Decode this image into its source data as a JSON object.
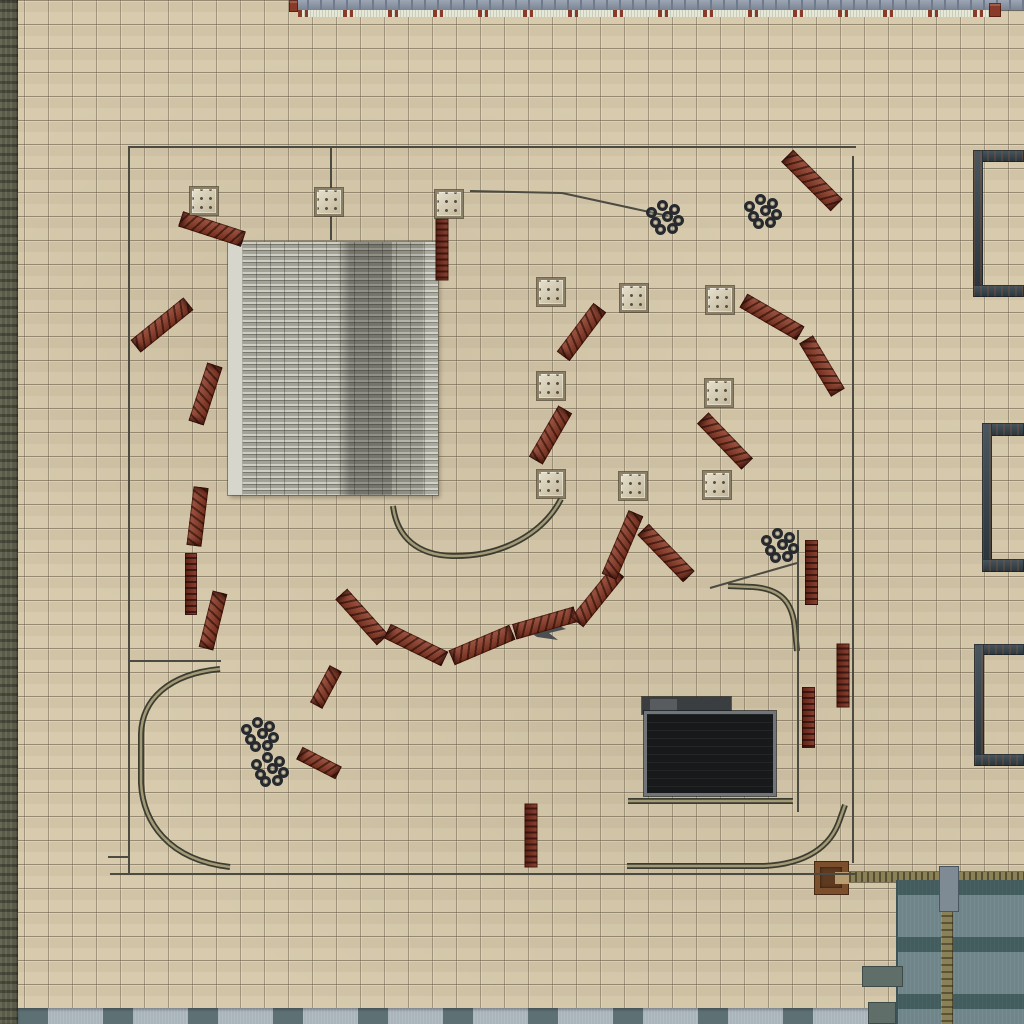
{
  "scene": {
    "description": "top-down desert training compound map with barriers, crates, tire stacks and track curves",
    "width": 1024,
    "height": 1024
  },
  "palette": {
    "ground": "#d7caad",
    "leftStrip": "#5b5b49",
    "topRoof": "#8b96a7",
    "topRoofSeam": "#6f7a8c",
    "paleStrip": "#e6e8d7",
    "redMark": "#8a3a28",
    "bStrip": "#a9b4bb",
    "bStripDark": "#5d7074",
    "roofMid": "#a2a296",
    "bracket": "#36444d",
    "darkUpper": "#3b3e40",
    "darkRoof": "#17191b",
    "darkFrame": "#70757a",
    "cornerBody": "#6f8589",
    "seamKhaki": "#8b8157",
    "wood": "#7c4f2c",
    "barrier": "#8f3a25",
    "ladderBase": "#7c2d1c",
    "crate": "#d9cfb2",
    "crateEdge": "#8b8066",
    "crateDot": "#5a5142",
    "tire": "#262a2f",
    "line": "#4b4b41",
    "trackDark": "#3c3c30",
    "trackKhaki": "#a29a76",
    "shadow": "#4c4f51"
  },
  "structures": [
    {
      "name": "left-edge-strip",
      "cls": "strip-left",
      "x": 0,
      "y": 0,
      "w": 18,
      "h": 1024
    },
    {
      "name": "top-building-roof",
      "cls": "top-roof",
      "x": 294,
      "y": 0,
      "w": 730,
      "h": 10
    },
    {
      "name": "top-pale-ledge",
      "cls": "top-pale",
      "x": 298,
      "y": 10,
      "w": 694,
      "h": 7
    },
    {
      "name": "top-red-crate-marks",
      "cls": "red-block",
      "x": 289,
      "y": 0,
      "w": 9,
      "h": 12
    },
    {
      "name": "top-right-red-block",
      "cls": "red-block",
      "x": 989,
      "y": 3,
      "w": 12,
      "h": 14
    },
    {
      "name": "bottom-roof-strip",
      "cls": "bottom-strip",
      "x": 18,
      "y": 1008,
      "w": 872,
      "h": 16
    },
    {
      "name": "corrugated-roof",
      "cls": "roof",
      "x": 228,
      "y": 242,
      "w": 210,
      "h": 253
    },
    {
      "name": "bracket-1-top",
      "cls": "bracket",
      "x": 973,
      "y": 150,
      "w": 51,
      "h": 12
    },
    {
      "name": "bracket-1-side",
      "cls": "bracket",
      "x": 973,
      "y": 150,
      "w": 10,
      "h": 147
    },
    {
      "name": "bracket-1-bottom",
      "cls": "bracket",
      "x": 973,
      "y": 285,
      "w": 51,
      "h": 12
    },
    {
      "name": "bracket-2-top",
      "cls": "bracket",
      "x": 982,
      "y": 423,
      "w": 42,
      "h": 13
    },
    {
      "name": "bracket-2-side",
      "cls": "bracket",
      "x": 982,
      "y": 423,
      "w": 10,
      "h": 148
    },
    {
      "name": "bracket-2-bottom",
      "cls": "bracket",
      "x": 982,
      "y": 559,
      "w": 42,
      "h": 13
    },
    {
      "name": "bracket-3-top",
      "cls": "bracket",
      "x": 974,
      "y": 644,
      "w": 50,
      "h": 11
    },
    {
      "name": "bracket-3-side",
      "cls": "bracket",
      "x": 974,
      "y": 644,
      "w": 10,
      "h": 122
    },
    {
      "name": "bracket-3-bottom",
      "cls": "bracket",
      "x": 974,
      "y": 754,
      "w": 50,
      "h": 12
    },
    {
      "name": "dark-building-upper",
      "cls": "dark-upper",
      "x": 642,
      "y": 697,
      "w": 89,
      "h": 17
    },
    {
      "name": "dark-building-upper-patch",
      "cls": "dark-upper-patch",
      "x": 650,
      "y": 699,
      "w": 27,
      "h": 13
    },
    {
      "name": "dark-building-main",
      "cls": "dark-main",
      "x": 644,
      "y": 711,
      "w": 132,
      "h": 85
    },
    {
      "name": "corner-building-top-bar",
      "cls": "khaki-bar",
      "x": 843,
      "y": 872,
      "w": 181,
      "h": 10
    },
    {
      "name": "corner-building-body",
      "cls": "corner-body",
      "x": 896,
      "y": 880,
      "w": 128,
      "h": 144
    },
    {
      "name": "corner-building-seam",
      "cls": "khaki-seam",
      "x": 941,
      "y": 880,
      "w": 12,
      "h": 144
    },
    {
      "name": "corner-building-seam-cap",
      "cls": "seam-cap",
      "x": 939,
      "y": 866,
      "w": 20,
      "h": 46
    },
    {
      "name": "corner-gray-block-1",
      "cls": "gray-block",
      "x": 862,
      "y": 966,
      "w": 41,
      "h": 21
    },
    {
      "name": "corner-gray-block-2",
      "cls": "gray-block",
      "x": 868,
      "y": 1002,
      "w": 28,
      "h": 22
    },
    {
      "name": "wooden-box-outer",
      "cls": "wood-outer",
      "x": 814,
      "y": 861,
      "w": 35,
      "h": 34
    },
    {
      "name": "wooden-box-inner",
      "cls": "wood-inner",
      "x": 820,
      "y": 867,
      "w": 22,
      "h": 21
    },
    {
      "name": "wooden-box-slot",
      "cls": "wood-slot",
      "x": 835,
      "y": 872,
      "w": 14,
      "h": 12
    }
  ],
  "lines": [
    [
      128,
      147,
      856,
      147
    ],
    [
      129,
      147,
      129,
      874
    ],
    [
      853,
      156,
      853,
      863
    ],
    [
      110,
      874,
      856,
      874
    ],
    [
      129,
      661,
      221,
      661
    ],
    [
      108,
      857,
      129,
      857
    ],
    [
      331,
      148,
      331,
      240
    ],
    [
      470,
      191,
      562,
      193
    ],
    [
      562,
      193,
      668,
      216
    ],
    [
      710,
      588,
      797,
      563
    ],
    [
      798,
      530,
      798,
      812
    ]
  ],
  "tracks": [
    {
      "name": "track-u-curve",
      "d": "M 393 506 C 397 538 418 555 452 556 C 504 557 544 532 561 499"
    },
    {
      "name": "track-quarter-turn",
      "d": "M 728 586 L 753 587 C 782 589 793 603 795 630 L 797 651"
    },
    {
      "name": "track-big-c-curve",
      "d": "M 220 669 C 168 674 142 700 141 734 L 141 783 C 143 822 168 860 230 867"
    },
    {
      "name": "track-bottom-right-curve",
      "d": "M 627 866 L 764 866 C 806 864 831 847 840 819 L 845 805"
    },
    {
      "name": "track-building-base",
      "d": "M 628 801 L 793 801"
    }
  ],
  "shadow_marker": {
    "points": "528,631 553,623 566,629 549,633 558,640 537,637"
  },
  "barriers": [
    {
      "x": 212,
      "y": 229,
      "l": 66,
      "w": 16,
      "a": 18
    },
    {
      "x": 442,
      "y": 249,
      "l": 62,
      "w": 13,
      "a": 90,
      "s": "ladder"
    },
    {
      "x": 162,
      "y": 325,
      "l": 68,
      "w": 16,
      "a": -39
    },
    {
      "x": 205,
      "y": 394,
      "l": 61,
      "w": 16,
      "a": -72
    },
    {
      "x": 197,
      "y": 516,
      "l": 59,
      "w": 15,
      "a": -83
    },
    {
      "x": 191,
      "y": 584,
      "l": 62,
      "w": 12,
      "a": 90,
      "s": "ladder"
    },
    {
      "x": 213,
      "y": 620,
      "l": 58,
      "w": 15,
      "a": -76
    },
    {
      "x": 326,
      "y": 687,
      "l": 42,
      "w": 14,
      "a": -62
    },
    {
      "x": 319,
      "y": 763,
      "l": 44,
      "w": 14,
      "a": 27
    },
    {
      "x": 362,
      "y": 617,
      "l": 62,
      "w": 16,
      "a": 48
    },
    {
      "x": 416,
      "y": 645,
      "l": 64,
      "w": 16,
      "a": 26
    },
    {
      "x": 482,
      "y": 645,
      "l": 66,
      "w": 16,
      "a": -23
    },
    {
      "x": 545,
      "y": 623,
      "l": 64,
      "w": 16,
      "a": -16
    },
    {
      "x": 597,
      "y": 597,
      "l": 65,
      "w": 16,
      "a": -51
    },
    {
      "x": 622,
      "y": 545,
      "l": 69,
      "w": 16,
      "a": -67
    },
    {
      "x": 666,
      "y": 553,
      "l": 66,
      "w": 16,
      "a": 46
    },
    {
      "x": 725,
      "y": 441,
      "l": 64,
      "w": 16,
      "a": 46
    },
    {
      "x": 581,
      "y": 332,
      "l": 61,
      "w": 16,
      "a": -53
    },
    {
      "x": 550,
      "y": 435,
      "l": 59,
      "w": 16,
      "a": -60
    },
    {
      "x": 772,
      "y": 317,
      "l": 66,
      "w": 16,
      "a": 30
    },
    {
      "x": 822,
      "y": 366,
      "l": 62,
      "w": 16,
      "a": 59
    },
    {
      "x": 812,
      "y": 180,
      "l": 70,
      "w": 17,
      "a": 45
    },
    {
      "x": 811,
      "y": 572,
      "l": 65,
      "w": 13,
      "a": 90,
      "s": "ladder"
    },
    {
      "x": 843,
      "y": 675,
      "l": 64,
      "w": 13,
      "a": 90,
      "s": "ladder"
    },
    {
      "x": 808,
      "y": 717,
      "l": 61,
      "w": 13,
      "a": 90,
      "s": "ladder"
    },
    {
      "x": 531,
      "y": 835,
      "l": 64,
      "w": 13,
      "a": 90,
      "s": "ladder"
    }
  ],
  "crate_size": 28,
  "crates": [
    [
      190,
      187
    ],
    [
      315,
      188
    ],
    [
      435,
      190
    ],
    [
      537,
      278
    ],
    [
      620,
      284
    ],
    [
      706,
      286
    ],
    [
      537,
      372
    ],
    [
      705,
      379
    ],
    [
      537,
      470
    ],
    [
      619,
      472
    ],
    [
      703,
      471
    ]
  ],
  "tire_clusters": [
    [
      665,
      218
    ],
    [
      763,
      212
    ],
    [
      780,
      546
    ],
    [
      260,
      735
    ],
    [
      270,
      770
    ]
  ],
  "tire_offsets": [
    [
      -13,
      -5
    ],
    [
      -2,
      -12
    ],
    [
      10,
      -8
    ],
    [
      -9,
      5
    ],
    [
      3,
      -1
    ],
    [
      14,
      3
    ],
    [
      -4,
      12
    ],
    [
      8,
      11
    ]
  ]
}
